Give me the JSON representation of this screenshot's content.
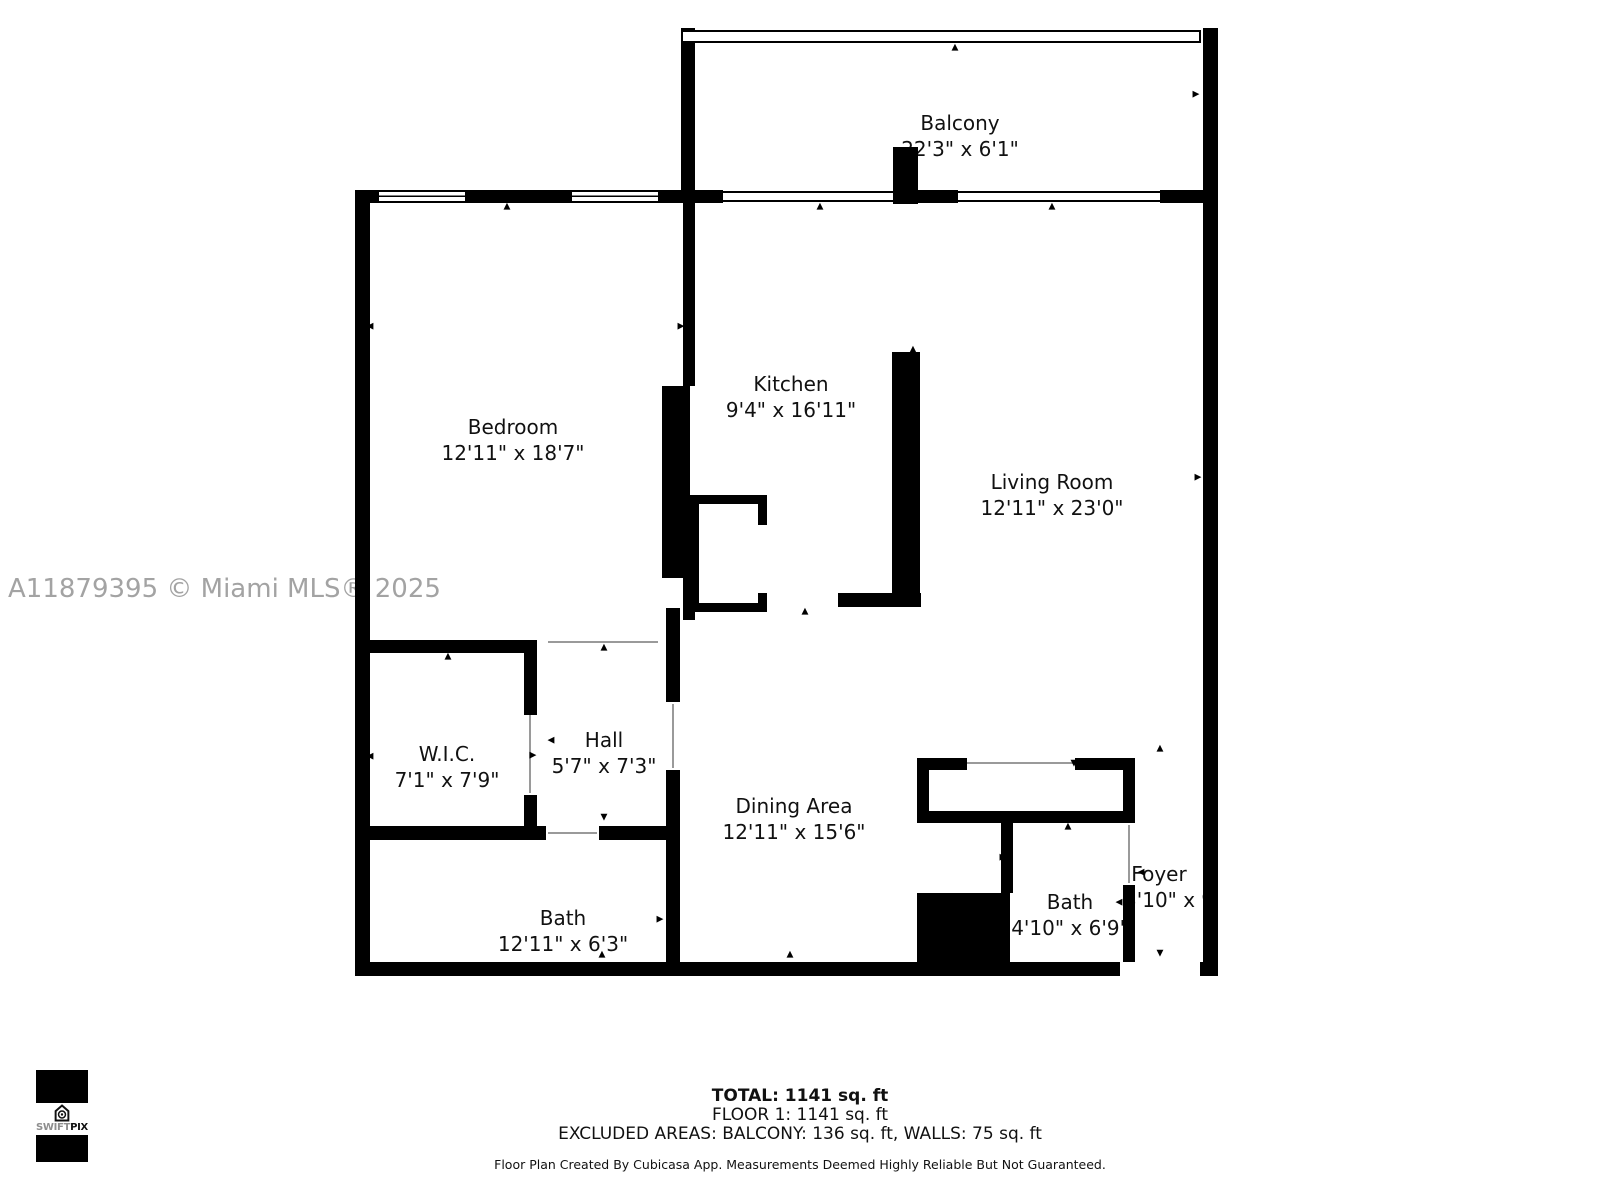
{
  "watermark": "A11879395 © Miami MLS® 2025",
  "rooms": [
    {
      "name": "Balcony",
      "dims": "22'3\" x 6'1\""
    },
    {
      "name": "Bedroom",
      "dims": "12'11\" x 18'7\""
    },
    {
      "name": "Kitchen",
      "dims": "9'4\" x 16'11\""
    },
    {
      "name": "Living Room",
      "dims": "12'11\" x 23'0\""
    },
    {
      "name": "W.I.C.",
      "dims": "7'1\" x 7'9\""
    },
    {
      "name": "Hall",
      "dims": "5'7\" x 7'3\""
    },
    {
      "name": "Dining Area",
      "dims": "12'11\" x 15'6\""
    },
    {
      "name": "Bath",
      "dims": "12'11\" x 6'3\""
    },
    {
      "name": "Bath",
      "dims": "4'10\" x 6'9\""
    },
    {
      "name": "Foyer",
      "dims": "3'10\" x 9'5\""
    }
  ],
  "summary": {
    "total": "TOTAL: 1141 sq. ft",
    "floor": "FLOOR 1: 1141 sq. ft",
    "excluded": "EXCLUDED AREAS: BALCONY: 136 sq. ft, WALLS: 75 sq. ft",
    "disclaimer": "Floor Plan Created By Cubicasa App. Measurements Deemed Highly Reliable But Not Guaranteed."
  },
  "logo": {
    "swift": "SWIFT",
    "pix": "PIX"
  },
  "colors": {
    "wall": "#000000",
    "watermark": "#a3a3a3",
    "door_line": "#9a9a9a"
  }
}
